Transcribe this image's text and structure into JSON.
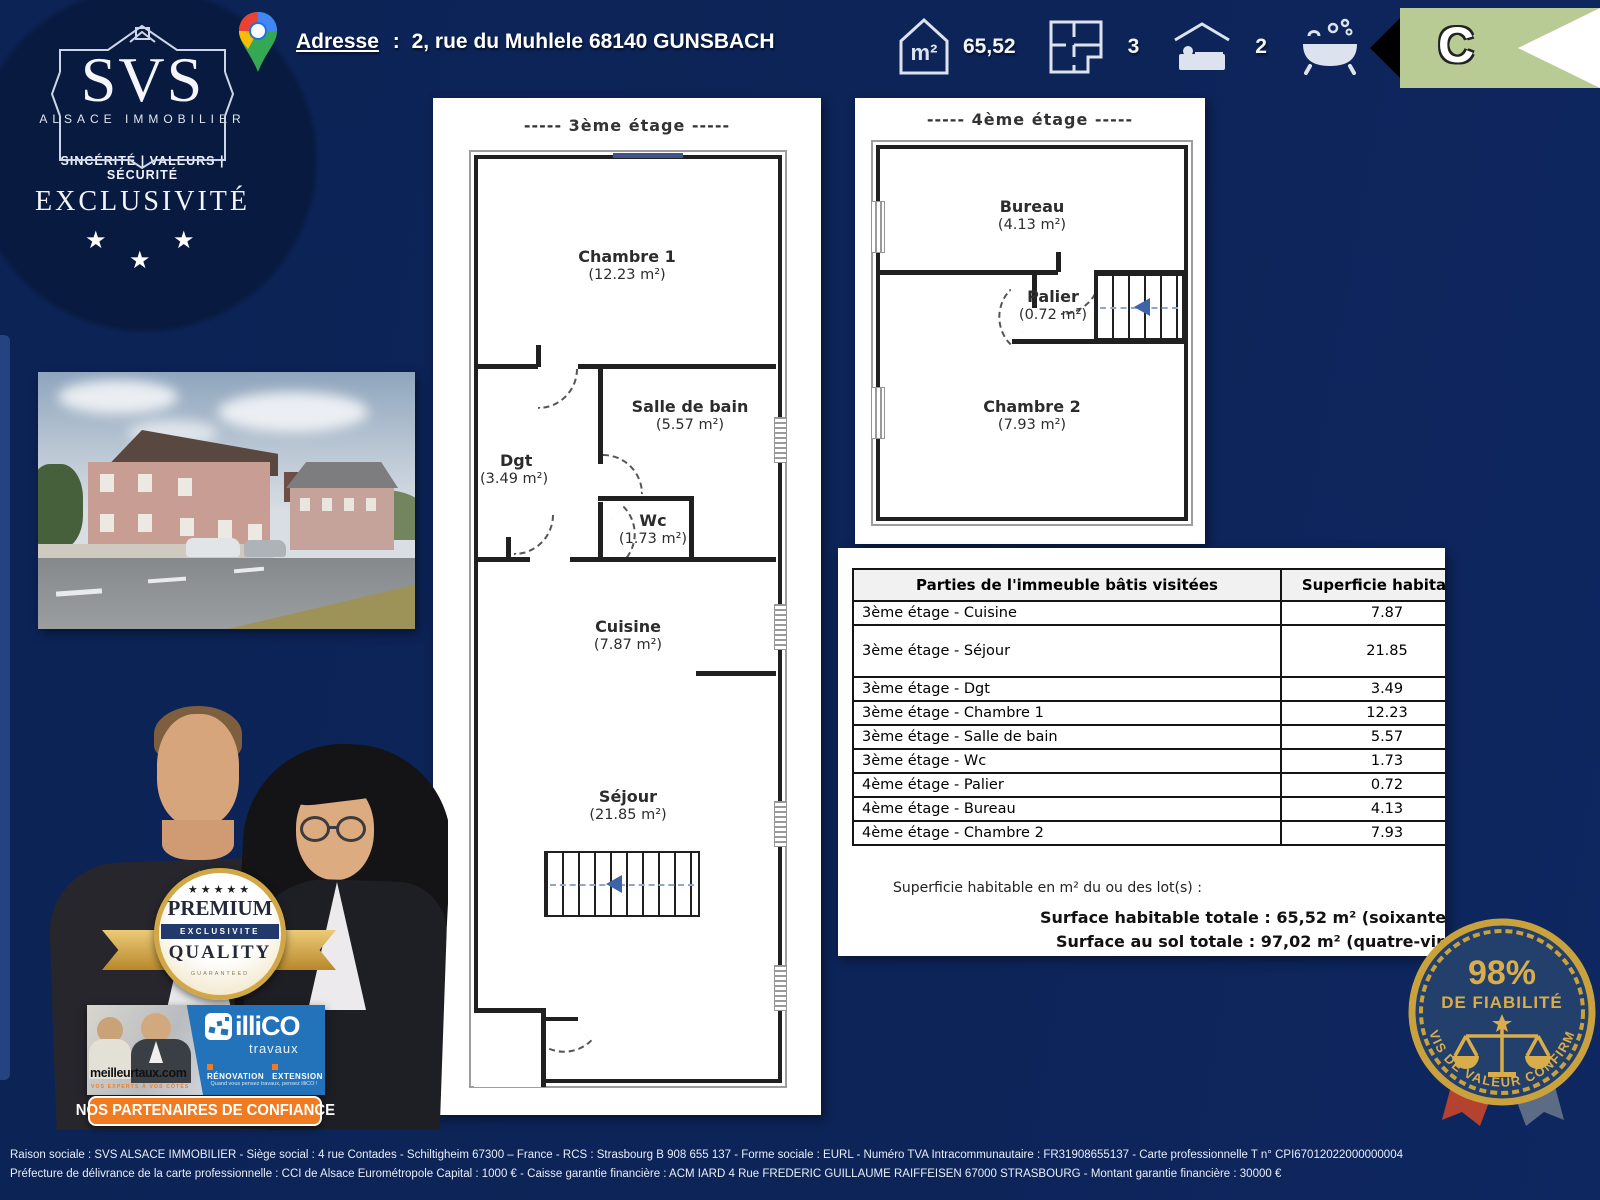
{
  "header": {
    "address": {
      "label": "Adresse",
      "sep": ":",
      "value": "2, rue du Muhlele 68140 GUNSBACH"
    },
    "stats": [
      {
        "icon": "area-icon",
        "label": "m²",
        "value": "65,52"
      },
      {
        "icon": "floorplan-icon",
        "value": "3"
      },
      {
        "icon": "bedrooms-icon",
        "value": "2"
      },
      {
        "icon": "bathrooms-icon",
        "value": "1"
      }
    ],
    "energy_class": "C"
  },
  "logo": {
    "name": "SVS",
    "subtitle": "ALSACE IMMOBILIER",
    "tagline": "SINCÉRITÉ | VALEURS | SÉCURITÉ",
    "banner": "EXCLUSIVITÉ",
    "stars": [
      "★",
      "★",
      "★"
    ]
  },
  "floor3": {
    "title": "-----  3ème étage  -----",
    "rooms": {
      "chambre1": {
        "name": "Chambre 1",
        "area": "(12.23 m²)"
      },
      "dgt": {
        "name": "Dgt",
        "area": "(3.49 m²)"
      },
      "sdb": {
        "name": "Salle de bain",
        "area": "(5.57 m²)"
      },
      "wc": {
        "name": "Wc",
        "area": "(1.73 m²)"
      },
      "cuisine": {
        "name": "Cuisine",
        "area": "(7.87 m²)"
      },
      "sejour": {
        "name": "Séjour",
        "area": "(21.85 m²)"
      }
    }
  },
  "floor4": {
    "title": "-----  4ème étage  -----",
    "rooms": {
      "bureau": {
        "name": "Bureau",
        "area": "(4.13 m²)"
      },
      "palier": {
        "name": "Palier",
        "area": "(0.72 m²)"
      },
      "chambre2": {
        "name": "Chambre 2",
        "area": "(7.93 m²)"
      }
    }
  },
  "surface_table": {
    "header": {
      "col1": "Parties de l'immeuble bâtis visitées",
      "col2": "Superficie habitable"
    },
    "rows": [
      {
        "label": "3ème étage - Cuisine",
        "value": "7.87"
      },
      {
        "label": "3ème étage - Séjour",
        "value": "21.85"
      },
      {
        "label": "3ème étage - Dgt",
        "value": "3.49"
      },
      {
        "label": "3ème étage - Chambre 1",
        "value": "12.23"
      },
      {
        "label": "3ème étage - Salle de bain",
        "value": "5.57"
      },
      {
        "label": "3ème étage - Wc",
        "value": "1.73"
      },
      {
        "label": "4ème étage - Palier",
        "value": "0.72"
      },
      {
        "label": "4ème étage - Bureau",
        "value": "4.13"
      },
      {
        "label": "4ème étage - Chambre 2",
        "value": "7.93"
      }
    ],
    "note": "Superficie habitable en m² du ou des lot(s) :",
    "total_habitable": "Surface habitable totale : 65,52 m² (soixante-cinq",
    "total_sol": "Surface au sol totale : 97,02 m² (quatre-vingt"
  },
  "premium_badge": {
    "stars": "★★★★★",
    "line1": "PREMIUM",
    "band": "EXCLUSIVITE",
    "line2": "QUALITY",
    "line3": "GUARANTEED"
  },
  "partners": {
    "banner": "NOS PARTENAIRES DE CONFIANCE",
    "meilleurtaux": {
      "brand": "meilleurtaux.com",
      "tagline": "VOS EXPERTS À VOS CÔTÉS"
    },
    "illico": {
      "brand": "illiCO",
      "brand_sub": "travaux",
      "item1": "RÉNOVATION",
      "item2": "EXTENSION",
      "caption": "Quand vous pensez travaux, pensez illiCO !"
    }
  },
  "fiability_badge": {
    "percent": "98%",
    "title": "DE FIABILITÉ",
    "arc_text": "AVIS DE VALEUR CONFIRMÉ"
  },
  "footer": {
    "line1": "Raison sociale : SVS ALSACE IMMOBILIER - Siège social : 4 rue Contades - Schiltigheim 67300 – France - RCS : Strasbourg B 908 655 137 - Forme sociale : EURL - Numéro TVA Intracommunautaire : FR31908655137 - Carte professionnelle T n° CPI67012022000000004",
    "line2": "Préfecture de délivrance de la carte professionnelle : CCI de Alsace Eurométropole   Capital : 1000 € -  Caisse garantie financière : ACM IARD 4 Rue FREDERIC GUILLAUME RAIFFEISEN 67000 STRASBOURG - Montant garantie financière : 30000 €"
  },
  "colors": {
    "background": "#0c2356",
    "energy_c": "#b9cb95",
    "orange": "#f07b20",
    "illico_blue": "#2273b9",
    "gold": "#d2a847",
    "seal_navy": "#23406d"
  }
}
